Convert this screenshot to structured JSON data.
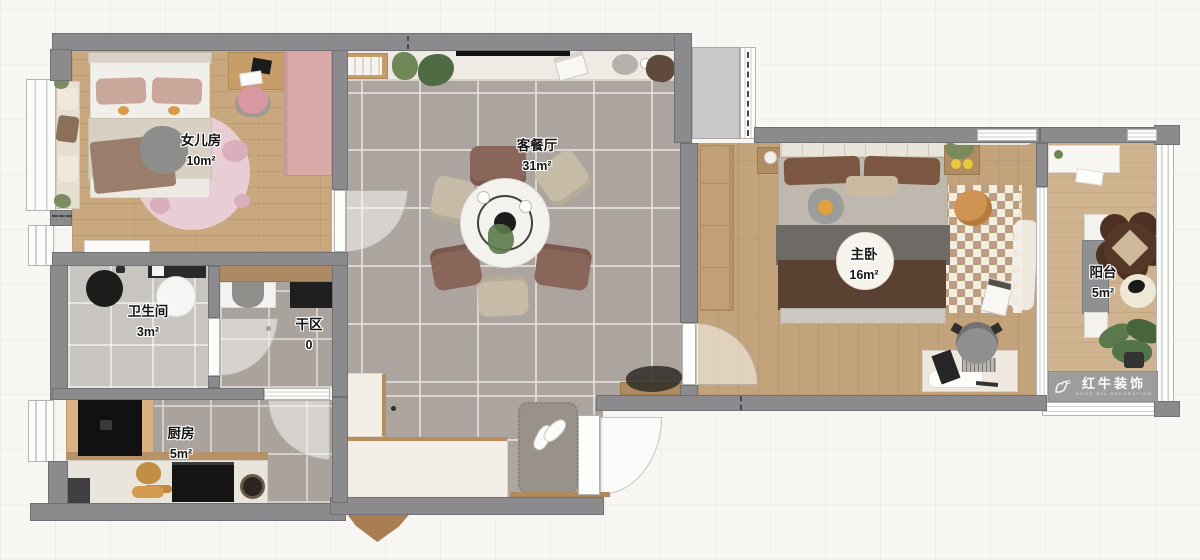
{
  "title": "apartment-floor-plan",
  "rooms": [
    {
      "id": "daughter-room",
      "name": "女儿房",
      "area": "10m²"
    },
    {
      "id": "living-dining",
      "name": "客餐厅",
      "area": "31m²"
    },
    {
      "id": "bathroom",
      "name": "卫生间",
      "area": "3m²"
    },
    {
      "id": "dry-area",
      "name": "干区",
      "area": "0"
    },
    {
      "id": "kitchen",
      "name": "厨房",
      "area": "5m²"
    },
    {
      "id": "master-bedroom",
      "name": "主卧",
      "area": "16m²"
    },
    {
      "id": "balcony",
      "name": "阳台",
      "area": "5m²"
    }
  ],
  "watermark": {
    "brand": "红牛装饰",
    "subtitle": "HONG NIU DECORATION"
  },
  "palette": {
    "wall": "#8b8b8e",
    "wood_floor": "#c3a37b",
    "daughter_wood": "#c9a87f",
    "balcony_wood": "#cfb38f",
    "tile_gray": "#aba49f",
    "tile_light": "#c8c4c0",
    "pink_wardrobe": "#d9aaa8",
    "pink_rug": "#e9cdd4",
    "chair_brown": "#8a665a",
    "chair_beige": "#c6bba6",
    "bed_brown": "#5a4132",
    "pouf_orange": "#cf9352",
    "watermark_bg": "#9d9d9b"
  }
}
